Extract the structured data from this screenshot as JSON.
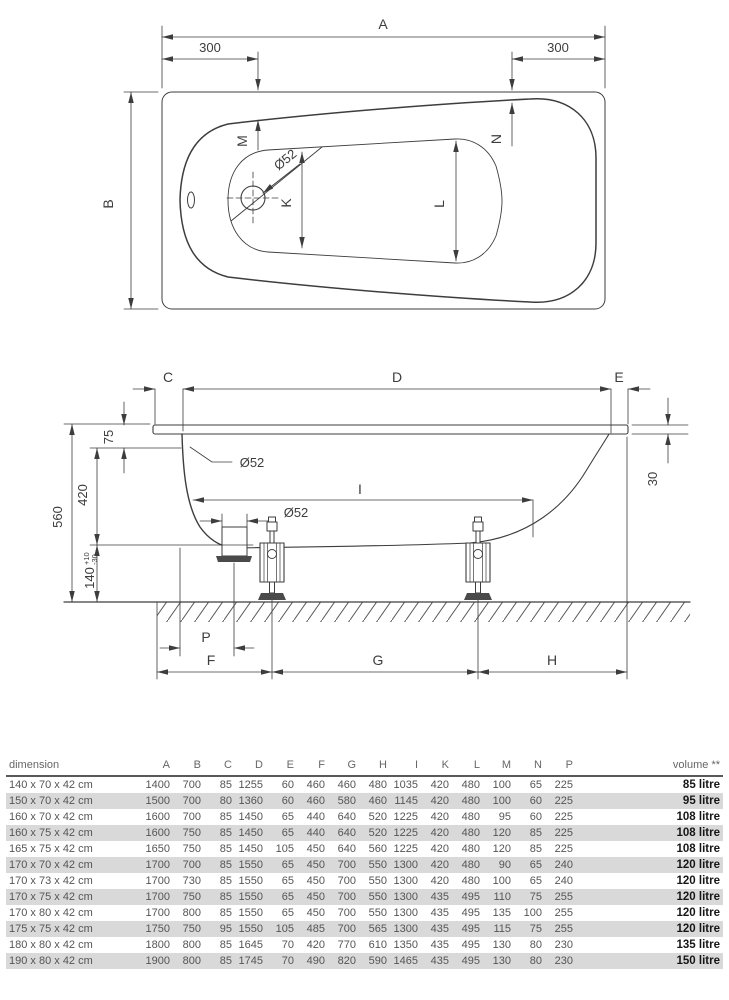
{
  "top_view": {
    "a": "A",
    "b": "B",
    "left_300": "300",
    "right_300": "300",
    "m": "M",
    "n": "N",
    "k": "K",
    "l": "L",
    "drain_dia": "Ø52"
  },
  "side_view": {
    "c": "C",
    "d": "D",
    "e": "E",
    "i": "I",
    "p": "P",
    "f": "F",
    "g": "G",
    "h": "H",
    "dim_75": "75",
    "dim_420": "420",
    "dim_560": "560",
    "dim_140": "140",
    "tol_plus": "+10",
    "tol_minus": "-30",
    "dim_30": "30",
    "overflow_dia": "Ø52",
    "drain_dia": "Ø52"
  },
  "table": {
    "headers": [
      "dimension",
      "A",
      "B",
      "C",
      "D",
      "E",
      "F",
      "G",
      "H",
      "I",
      "K",
      "L",
      "M",
      "N",
      "P",
      "volume **"
    ],
    "rows": [
      {
        "dimension": "140 x 70 x 42 cm",
        "values": [
          "1400",
          "700",
          "85",
          "1255",
          "60",
          "460",
          "460",
          "480",
          "1035",
          "420",
          "480",
          "100",
          "65",
          "225"
        ],
        "volume": "85 litre"
      },
      {
        "dimension": "150 x 70 x 42 cm",
        "values": [
          "1500",
          "700",
          "80",
          "1360",
          "60",
          "460",
          "580",
          "460",
          "1145",
          "420",
          "480",
          "100",
          "60",
          "225"
        ],
        "volume": "95 litre"
      },
      {
        "dimension": "160 x 70 x 42 cm",
        "values": [
          "1600",
          "700",
          "85",
          "1450",
          "65",
          "440",
          "640",
          "520",
          "1225",
          "420",
          "480",
          "95",
          "60",
          "225"
        ],
        "volume": "108 litre"
      },
      {
        "dimension": "160 x 75 x 42 cm",
        "values": [
          "1600",
          "750",
          "85",
          "1450",
          "65",
          "440",
          "640",
          "520",
          "1225",
          "420",
          "480",
          "120",
          "85",
          "225"
        ],
        "volume": "108 litre"
      },
      {
        "dimension": "165 x 75 x 42 cm",
        "values": [
          "1650",
          "750",
          "85",
          "1450",
          "105",
          "450",
          "640",
          "560",
          "1225",
          "420",
          "480",
          "120",
          "85",
          "225"
        ],
        "volume": "108 litre"
      },
      {
        "dimension": "170 x 70 x 42 cm",
        "values": [
          "1700",
          "700",
          "85",
          "1550",
          "65",
          "450",
          "700",
          "550",
          "1300",
          "420",
          "480",
          "90",
          "65",
          "240"
        ],
        "volume": "120 litre"
      },
      {
        "dimension": "170 x 73 x 42 cm",
        "values": [
          "1700",
          "730",
          "85",
          "1550",
          "65",
          "450",
          "700",
          "550",
          "1300",
          "420",
          "480",
          "100",
          "65",
          "240"
        ],
        "volume": "120 litre"
      },
      {
        "dimension": "170 x 75 x 42 cm",
        "values": [
          "1700",
          "750",
          "85",
          "1550",
          "65",
          "450",
          "700",
          "550",
          "1300",
          "435",
          "495",
          "110",
          "75",
          "255"
        ],
        "volume": "120 litre"
      },
      {
        "dimension": "170 x 80 x 42 cm",
        "values": [
          "1700",
          "800",
          "85",
          "1550",
          "65",
          "450",
          "700",
          "550",
          "1300",
          "435",
          "495",
          "135",
          "100",
          "255"
        ],
        "volume": "120 litre"
      },
      {
        "dimension": "175 x 75 x 42 cm",
        "values": [
          "1750",
          "750",
          "95",
          "1550",
          "105",
          "485",
          "700",
          "565",
          "1300",
          "435",
          "495",
          "115",
          "75",
          "255"
        ],
        "volume": "120 litre"
      },
      {
        "dimension": "180 x 80 x 42 cm",
        "values": [
          "1800",
          "800",
          "85",
          "1645",
          "70",
          "420",
          "770",
          "610",
          "1350",
          "435",
          "495",
          "130",
          "80",
          "230"
        ],
        "volume": "135 litre"
      },
      {
        "dimension": "190 x 80 x 42 cm",
        "values": [
          "1900",
          "800",
          "85",
          "1745",
          "70",
          "490",
          "820",
          "590",
          "1465",
          "435",
          "495",
          "130",
          "80",
          "230"
        ],
        "volume": "150 litre"
      }
    ]
  },
  "colors": {
    "line": "#3d3d3d",
    "table_stripe": "#d9d9d9",
    "table_text": "#555555",
    "volume_text": "#161616"
  }
}
